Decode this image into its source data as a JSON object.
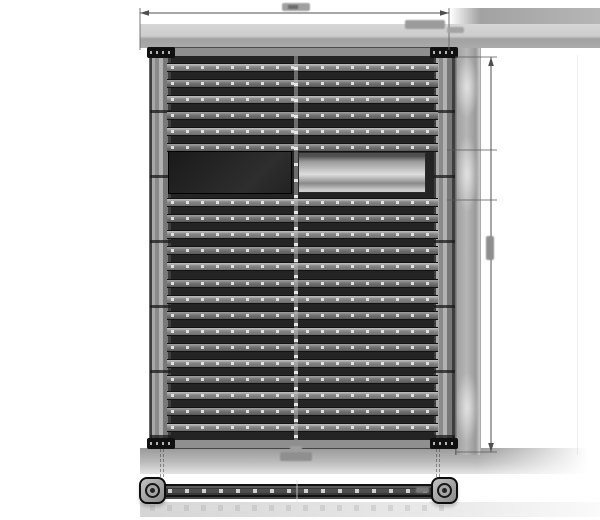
{
  "colors": {
    "bg": "#ffffff",
    "band_light": "#d6d6d6",
    "band_dark": "#a2a2a2",
    "shadow_top": "#999999",
    "rail": "#8f8f8f",
    "rail_line": "#3e3e3e",
    "interior": "#242424",
    "bar_hi": "#c0c0c0",
    "bar_lo": "#6c6c6c",
    "bar_dot": "#e4e4e4",
    "gap_line": "#121212",
    "bracket": "#101010",
    "driver_dark": "#1a1a1a",
    "metal_hi": "#dedede",
    "metal_lo": "#4f4f4f",
    "spine": "#c4c4c4",
    "dim_line": "#4f4f4f",
    "smudge": "#8d8d8d",
    "strip": "#b6b6b6",
    "cap_face": "#c2c2c2",
    "cap_line": "#0d0d0d",
    "sidebar_body": "#383838",
    "sidebar_dash": "#d0d0d0"
  },
  "fixture": {
    "led_bars_above_driver": 6,
    "led_bars_below_driver": 15,
    "driver_boxes": 2,
    "corner_brackets": 4,
    "has_center_spine": true
  },
  "side_bar_view": {
    "end_caps": 2,
    "has_led_dash_row": true
  },
  "dimension_annotations": {
    "top_width_line": true,
    "right_height_line": true,
    "labels_legible": false
  }
}
